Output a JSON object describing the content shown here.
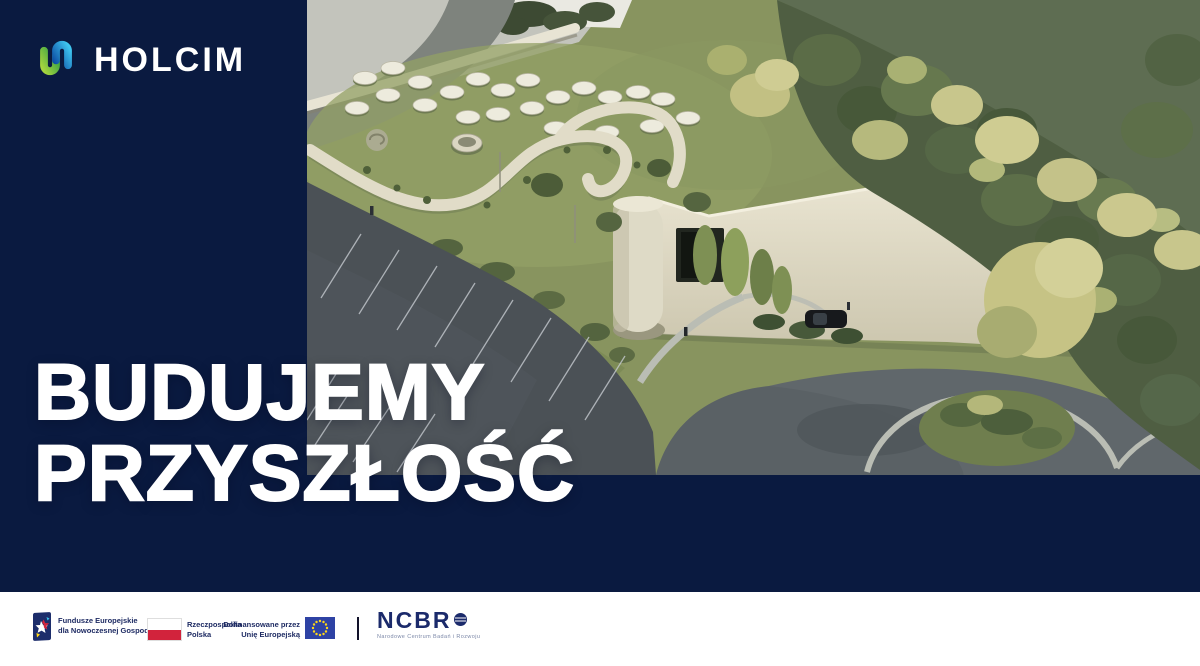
{
  "brand": {
    "name": "HOLCIM",
    "icon": "holcim-link-icon"
  },
  "hero": {
    "line1": "BUDUJEMY",
    "line2": "PRZYSZŁOŚĆ"
  },
  "scene": {
    "alt": "Aerial architectural rendering of a curved green-roof facility with circular rooftop tanks, winding concrete walls, dark parking lot, curved paths and surrounding trees and meadow"
  },
  "footer": {
    "eu_funds": {
      "line1": "Fundusze Europejskie",
      "line2": "dla Nowoczesnej Gospodarki"
    },
    "poland": {
      "line1": "Rzeczpospolita",
      "line2": "Polska"
    },
    "eu_cofunding": {
      "line1": "Dofinansowane przez",
      "line2": "Unię Europejską"
    },
    "ncbr": {
      "name": "NCBR",
      "subtitle": "Narodowe Centrum Badań i Rozwoju"
    }
  },
  "colors": {
    "navy": "#0a1a40",
    "white": "#ffffff",
    "holcim_blue_dark": "#0d4fa6",
    "holcim_blue_light": "#3fc6f0",
    "holcim_green_dark": "#2f9e45",
    "holcim_green_light": "#a6d53e",
    "poland_red": "#d2233c",
    "eu_blue": "#2e42a4",
    "eu_star_yellow": "#ffd617",
    "footer_text_navy": "#1e2b63"
  }
}
